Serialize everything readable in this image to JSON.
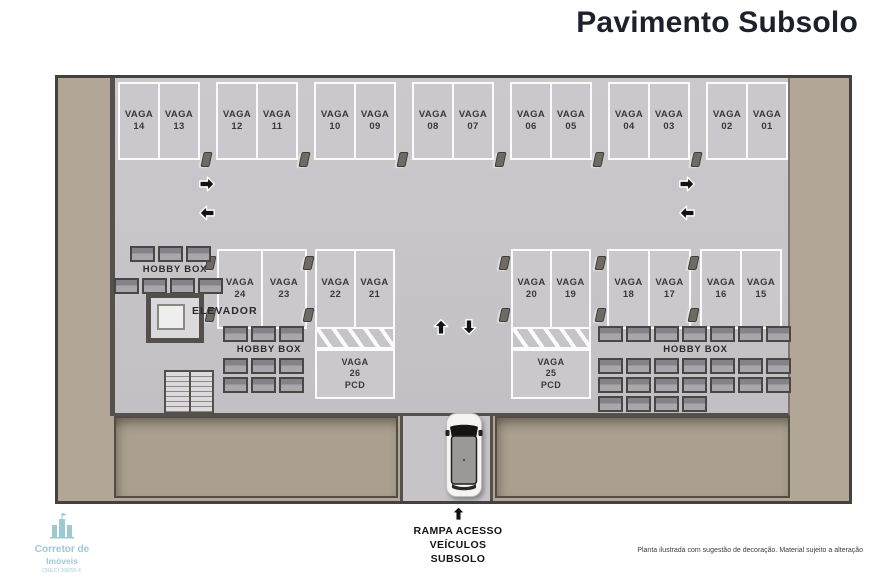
{
  "header": {
    "title": "Pavimento Subsolo"
  },
  "plan": {
    "space_word": "VAGA",
    "top_row_pairs": [
      [
        "14",
        "13"
      ],
      [
        "12",
        "11"
      ],
      [
        "10",
        "09"
      ],
      [
        "08",
        "07"
      ],
      [
        "06",
        "05"
      ],
      [
        "04",
        "03"
      ],
      [
        "02",
        "01"
      ]
    ],
    "middle_groups": [
      [
        "24",
        "23"
      ],
      [
        "22",
        "21"
      ],
      [
        "20",
        "19"
      ],
      [
        "18",
        "17"
      ],
      [
        "16",
        "15"
      ]
    ],
    "pcd_spaces": [
      {
        "num": "26",
        "tag": "PCD"
      },
      {
        "num": "25",
        "tag": "PCD"
      }
    ],
    "labels": {
      "hobby_box": "HOBBY BOX",
      "elevator": "ELEVADOR"
    },
    "hobby_grids": {
      "left_row1": {
        "rows": 1,
        "cols": 3
      },
      "left_row2": {
        "rows": 1,
        "cols": 4
      },
      "center_row1": {
        "rows": 1,
        "cols": 3
      },
      "center_grid": {
        "rows": 2,
        "cols": 3
      },
      "right_row1": {
        "rows": 1,
        "cols": 7
      },
      "right_grid": {
        "rows": 2,
        "cols": 7
      },
      "right_extra": {
        "rows": 1,
        "cols": 4
      }
    }
  },
  "ramp": {
    "caption_lines": [
      "RAMPA ACESSO",
      "VEÍCULOS",
      "SUBSOLO"
    ]
  },
  "icons": {
    "flow_right": "arrow-right",
    "flow_left": "arrow-left",
    "ramp_up": "arrow-up",
    "ramp_down": "arrow-down",
    "entry_up": "arrow-up"
  },
  "watermark": {
    "brand_top": "Corretor de",
    "brand_bottom": "Imóveis",
    "registry": "CRECI 39055-F"
  },
  "disclaimer": "Planta ilustrada com sugestão de decoração. Material sujeito a alteração",
  "colors": {
    "title": "#1d212c",
    "earth": "#b2a797",
    "slab": "#c6c4c8",
    "wall": "#55504c",
    "space_outline": "#fbfbfc",
    "watermark_teal": "#8fc0cb"
  }
}
